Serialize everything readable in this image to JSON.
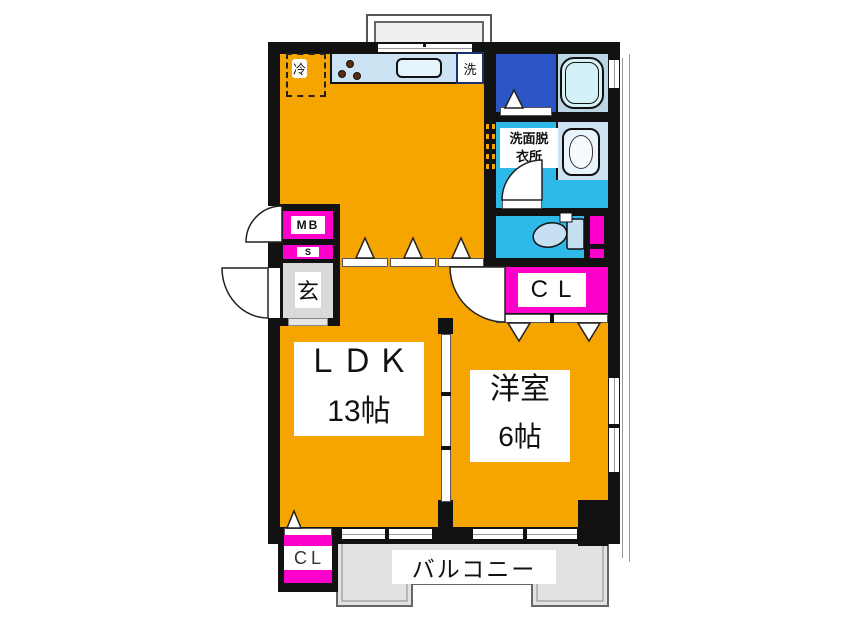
{
  "rooms": {
    "ldk": {
      "name": "ＬＤＫ",
      "size": "13帖"
    },
    "western": {
      "name": "洋室",
      "size": "6帖"
    },
    "balcony": {
      "name": "バルコニー"
    },
    "washroom": {
      "line1": "洗面脱",
      "line2": "衣所"
    },
    "entrance": {
      "name": "玄"
    }
  },
  "fixtures": {
    "refrigerator": "冷",
    "washing_machine": "洗"
  },
  "storage": {
    "meter_box": "MB",
    "shaft": "S",
    "closet_right": "CL",
    "closet_bottom": "CL"
  },
  "colors": {
    "wall": "#111111",
    "orange": "#F5A400",
    "magenta": "#FF00CC",
    "cyan": "#2FB9E9",
    "bath": "#2B55C4",
    "counter": "#CBE3F3",
    "tub": "#D4F1F7",
    "panel": "#BCD6E6",
    "basin": "#CDE2F0",
    "balcony": "#E2E2E2",
    "genkan": "#D9D9D9"
  }
}
